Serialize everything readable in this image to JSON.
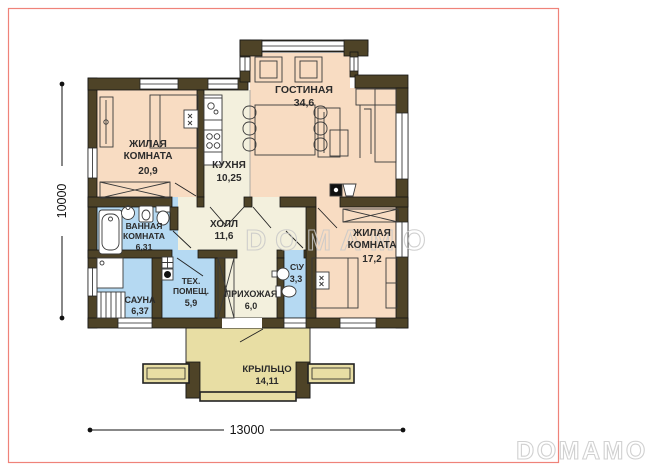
{
  "plan": {
    "rooms": {
      "bedroom1": {
        "label": "ЖИЛАЯ",
        "label2": "КОМНАТА",
        "area": "20,9"
      },
      "kitchen": {
        "label": "КУХНЯ",
        "area": "10,25"
      },
      "living": {
        "label": "ГОСТИНАЯ",
        "area": "34,6"
      },
      "bathroom": {
        "label": "ВАННАЯ",
        "label2": "КОМНАТА",
        "area": "6,31"
      },
      "hall": {
        "label": "ХОЛЛ",
        "area": "11,6"
      },
      "sauna": {
        "label": "САУНА",
        "area": "6,37"
      },
      "tech": {
        "label": "ТЕХ.",
        "label2": "ПОМЕЩ.",
        "area": "5,9"
      },
      "entry": {
        "label": "ПРИХОЖАЯ",
        "area": "6,0"
      },
      "wc": {
        "label": "С\\У",
        "area": "3,3"
      },
      "bedroom2": {
        "label": "ЖИЛАЯ",
        "label2": "КОМНАТА",
        "area": "17,2"
      },
      "porch": {
        "label": "КРЫЛЬЦО",
        "area": "14,11"
      }
    },
    "dimensions": {
      "width_label": "13000",
      "height_label": "10000"
    },
    "watermark": {
      "center_text": "DOMAMO",
      "logo_text": "DOMAMO"
    },
    "colors": {
      "wall": "#4e4327",
      "room_peach": "#f8dcc2",
      "room_cream": "#f3f0dd",
      "room_blue": "#b5d9f2",
      "porch_tan": "#e8dea4",
      "frame_red": "#ef8379",
      "fixture_white": "#ffffff"
    }
  }
}
